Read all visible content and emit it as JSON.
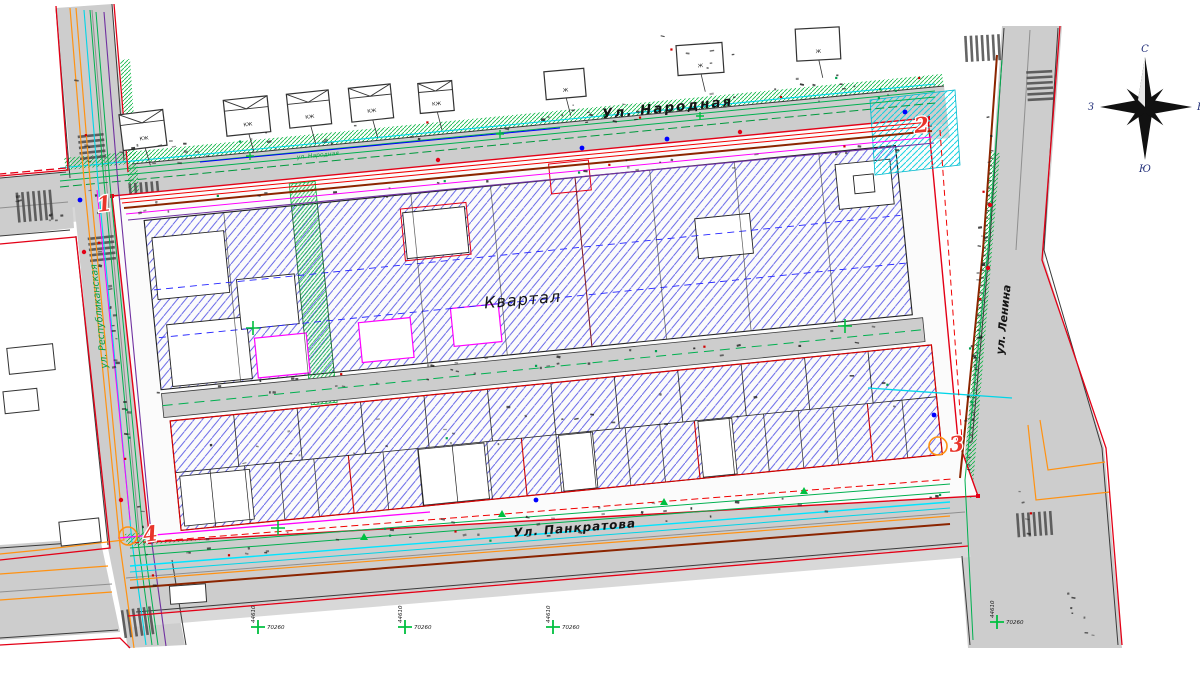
{
  "map_labels": {
    "block": "Квартал",
    "street_top": "Ул. Народная",
    "street_top_small": "ул. Народная",
    "street_bottom": "Ул. Панкратова",
    "street_right": "ул. Ленина",
    "street_left": "ул. Республиканская"
  },
  "compass": {
    "north": "С",
    "south": "Ю",
    "west": "З",
    "east": "В"
  },
  "corner_markers": [
    {
      "n": "1"
    },
    {
      "n": "2"
    },
    {
      "n": "3"
    },
    {
      "n": "4"
    }
  ],
  "survey_crosses": [
    {
      "h": "70260",
      "v": "44610"
    },
    {
      "h": "70260",
      "v": "44610"
    },
    {
      "h": "70260",
      "v": "44610"
    },
    {
      "h": "70260",
      "v": "44610"
    }
  ],
  "building_labels": [
    "КЖ",
    "КЖ",
    "КЖ",
    "КЖ",
    "КЖ",
    "Ж",
    "Ж",
    "Ж"
  ],
  "colors": {
    "boundary_red": "#e30016",
    "hatch_blue": "#2f2fe0",
    "utility_green": "#00b050",
    "utility_cyan": "#00d5e8",
    "utility_orange": "#ff9212",
    "utility_magenta": "#ff00ff",
    "utility_purple": "#7030a0",
    "road_gray": "#cdcdcd"
  }
}
